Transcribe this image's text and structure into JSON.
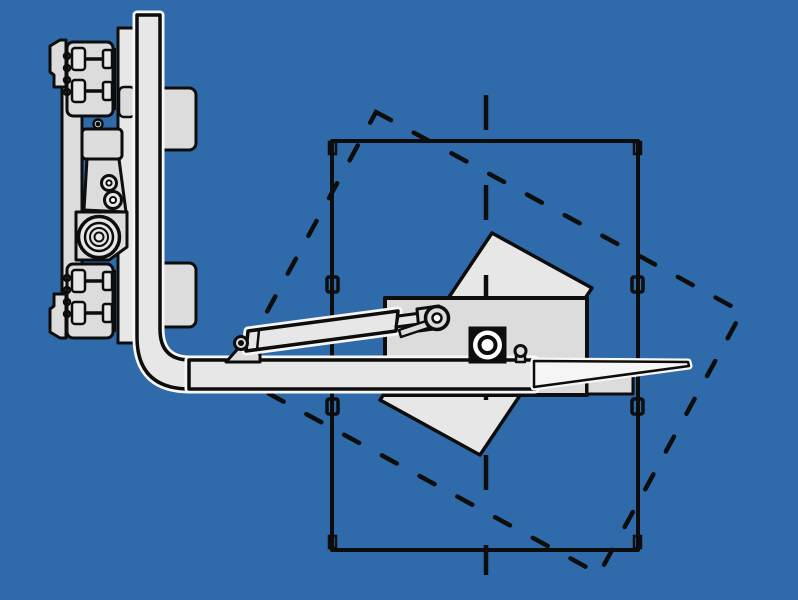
{
  "canvas": {
    "width": 798,
    "height": 600
  },
  "colors": {
    "bg": "#2f6bab",
    "line": "#0d0d0d",
    "part": "#dcdcdc",
    "part-light": "#e7e7e7",
    "blade": "#f5f5f5",
    "halo": "#f7f7f7"
  },
  "diagram": {
    "kind": "technical line illustration",
    "subject": "fork-mounted drum rotator attachment gripping a drum, rotated drum position shown dashed",
    "text_labels": [],
    "line_styles": {
      "drum_rotated_outline": "dashed",
      "drum_axis_centerline": "long-dash",
      "solid_parts": "black outline with light gray fill"
    }
  },
  "parts": {
    "carriage": [
      "carriage-bar",
      "hook-block-top",
      "hook-block-bottom",
      "mount-flag-top",
      "mount-flag-bottom",
      "mount-plate",
      "latch-tab",
      "hanger-bracket-top",
      "hanger-bracket-bottom",
      "motor-box",
      "link-bracket",
      "roller-small-upper",
      "roller-small-lower",
      "roller-plate",
      "roller-large"
    ],
    "fork": [
      "fork-shank-elbow",
      "fork-arm",
      "fork-blade"
    ],
    "rotator": [
      "rotator-body",
      "clamp-frame-rotated",
      "clamp-jaw",
      "rotator-hub",
      "adjust-knob",
      "cylinder-mount",
      "cylinder-tube",
      "cylinder-rod",
      "rod-end",
      "rod-end-eye",
      "clevis-pin",
      "link-bar"
    ],
    "drum": [
      "drum-outline",
      "drum-chime-lips",
      "drum-hoop-clips",
      "drum-rotated-dashed-outline",
      "drum-centerline"
    ]
  }
}
